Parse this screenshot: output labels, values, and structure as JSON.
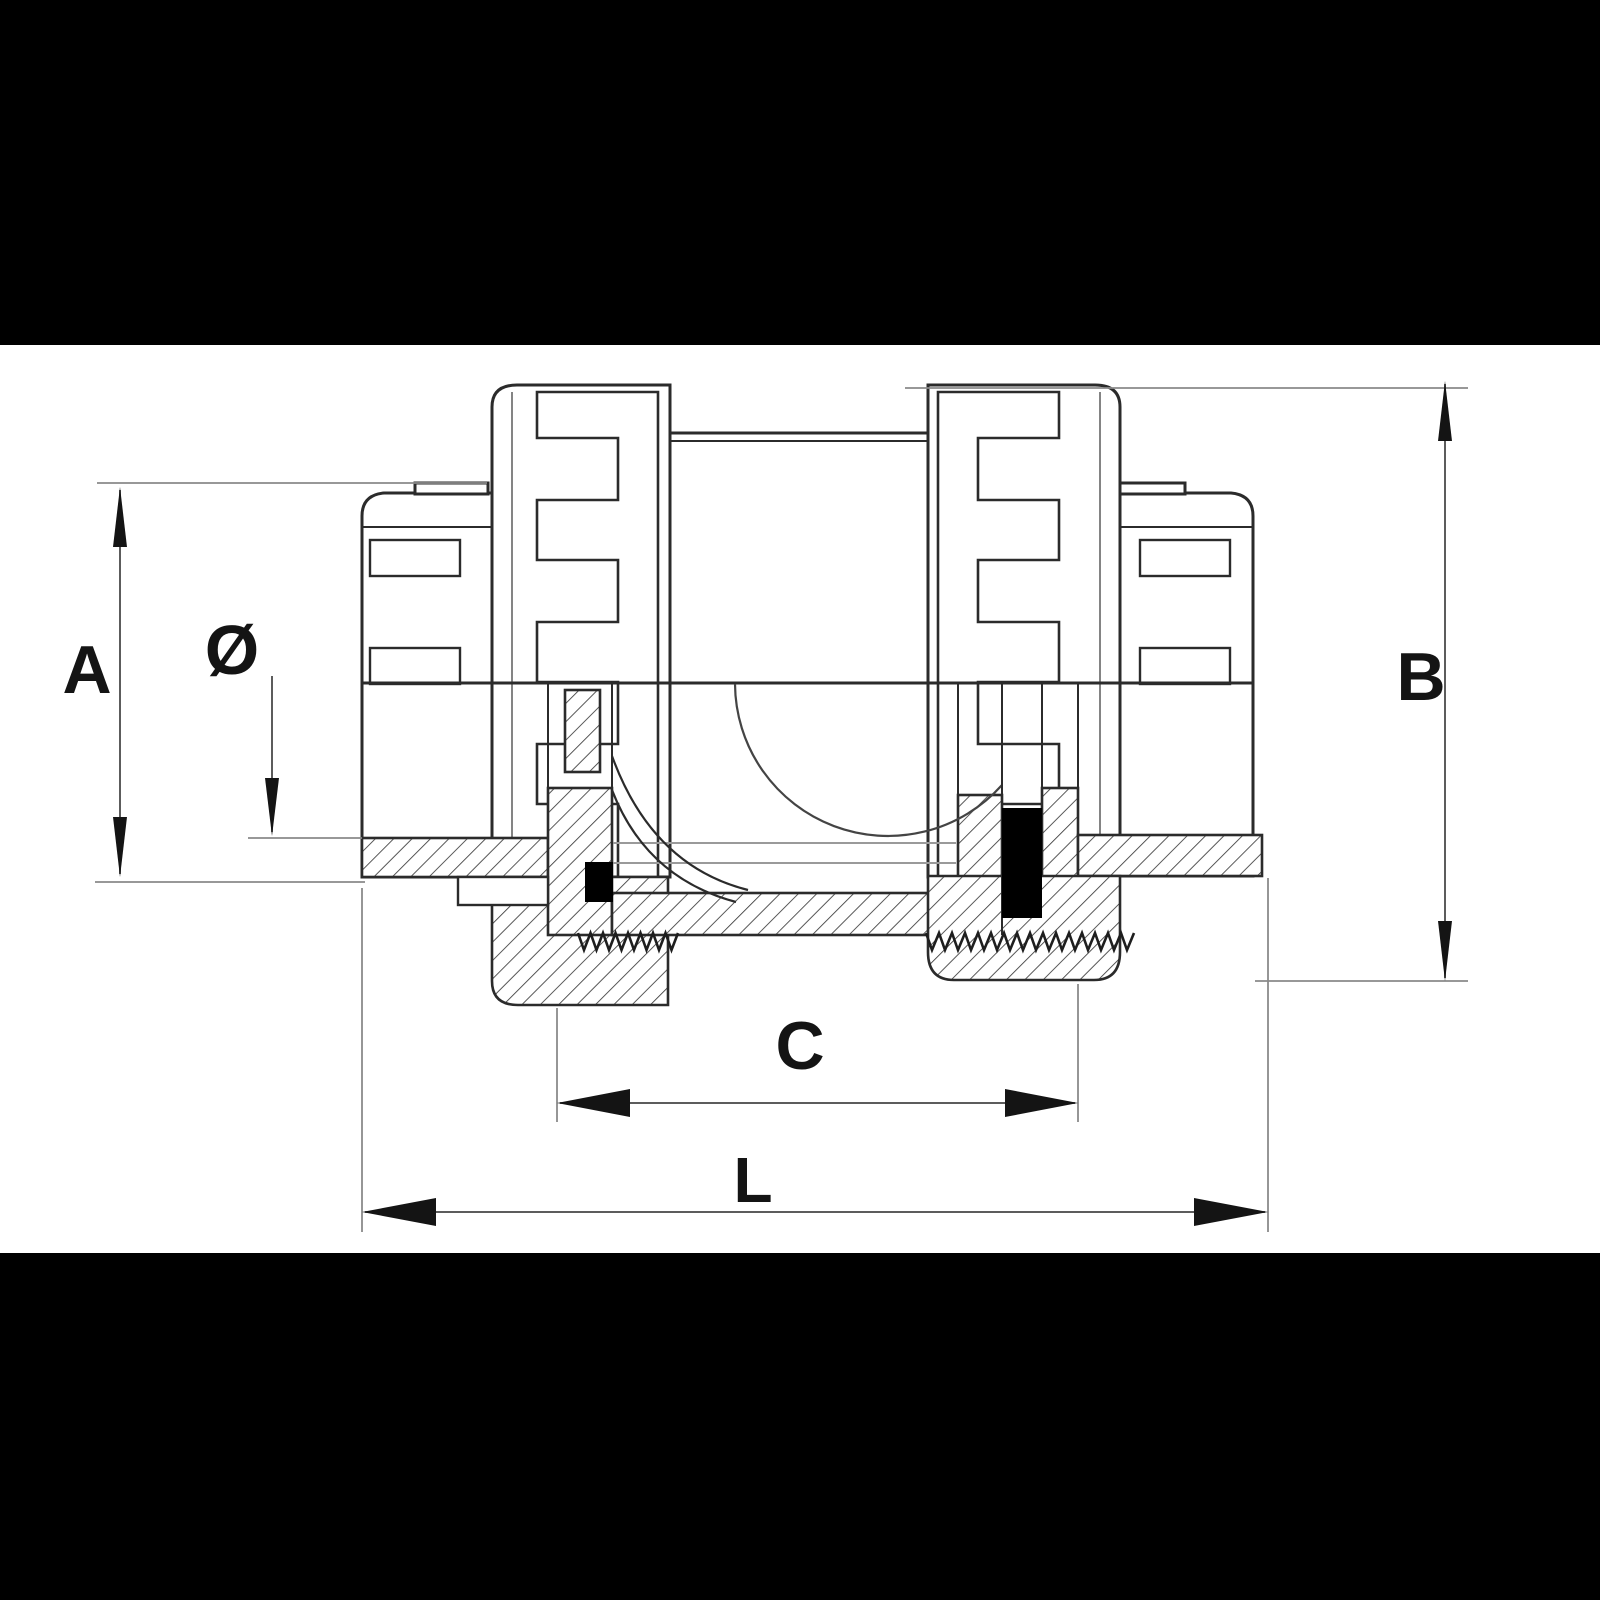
{
  "page": {
    "background": "#000000",
    "canvas_background": "#ffffff"
  },
  "drawing": {
    "type": "technical-drawing",
    "subject": "union check valve sectional view with dimension callouts",
    "line_color": "#2b2b2b",
    "hatch_color": "#3a3a3a",
    "seal_color": "#000000"
  },
  "dimension_labels": {
    "a": "A",
    "diameter": "Ø",
    "b": "B",
    "c": "C",
    "l": "L"
  }
}
